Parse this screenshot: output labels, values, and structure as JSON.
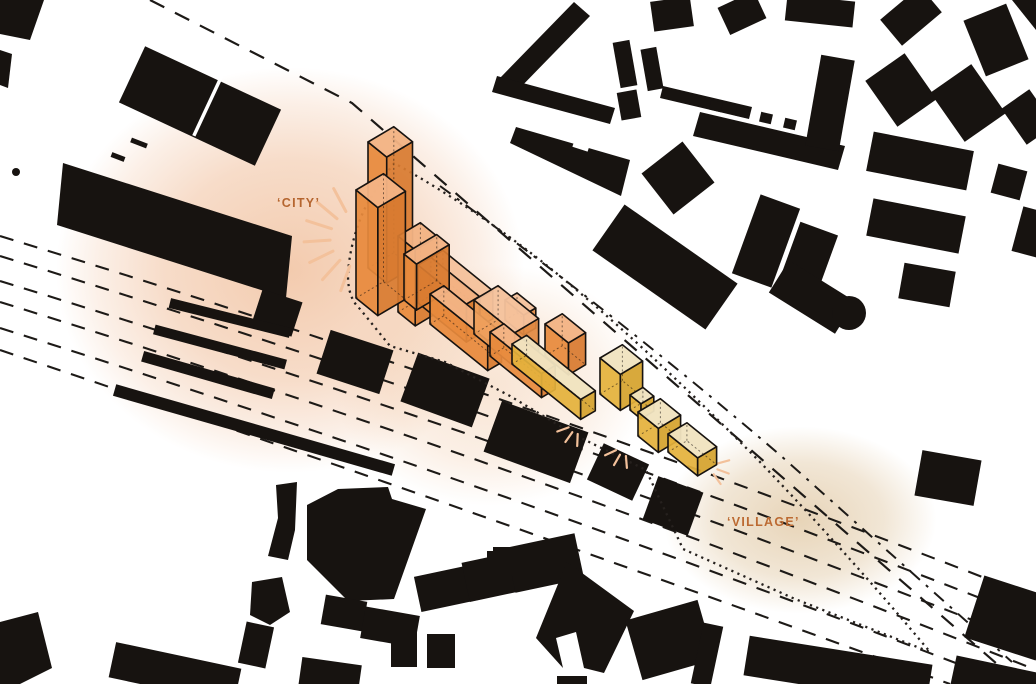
{
  "diagram": {
    "type": "architectural figure-ground site plan with axonometric massing overlay",
    "annotations": {
      "city_label": "‘CITY’",
      "village_label": "‘VILLAGE’"
    },
    "masses": [
      {
        "name": "city tower (rear)",
        "palette": "orange"
      },
      {
        "name": "city tower (front)",
        "palette": "orange"
      },
      {
        "name": "tower annex",
        "palette": "orange"
      },
      {
        "name": "mid-rise slab row",
        "palette": "orange"
      },
      {
        "name": "courtyard blocks",
        "palette": "orange"
      },
      {
        "name": "transition bar",
        "palette": "yellow"
      },
      {
        "name": "village cubes",
        "palette": "yellow"
      }
    ],
    "site_features": [
      "railway tracks (dashed)",
      "street edges (dash-dot)",
      "site boundary (dotted)",
      "sun rays",
      "city glow",
      "village glow"
    ]
  },
  "colors": {
    "ink": "#171310",
    "track": "#1D1A17",
    "boundary": "#26211E",
    "city_label": "#B5652F",
    "village_label": "#BC6A32",
    "glow_city": "#EBA878",
    "glow_mid": "#F0C49E",
    "glow_village": "#D9BA8C",
    "ray": "#F3C19B",
    "or_front": "#E78A3C",
    "or_top": "#F2B384",
    "or_side": "#D87B30",
    "or2_front": "#EE9D58",
    "or2_top": "#F5C29C",
    "or2_side": "#E18A42",
    "ye_front": "#E4B23C",
    "ye_top": "#F0E3BF",
    "ye_side": "#D5A22D"
  }
}
